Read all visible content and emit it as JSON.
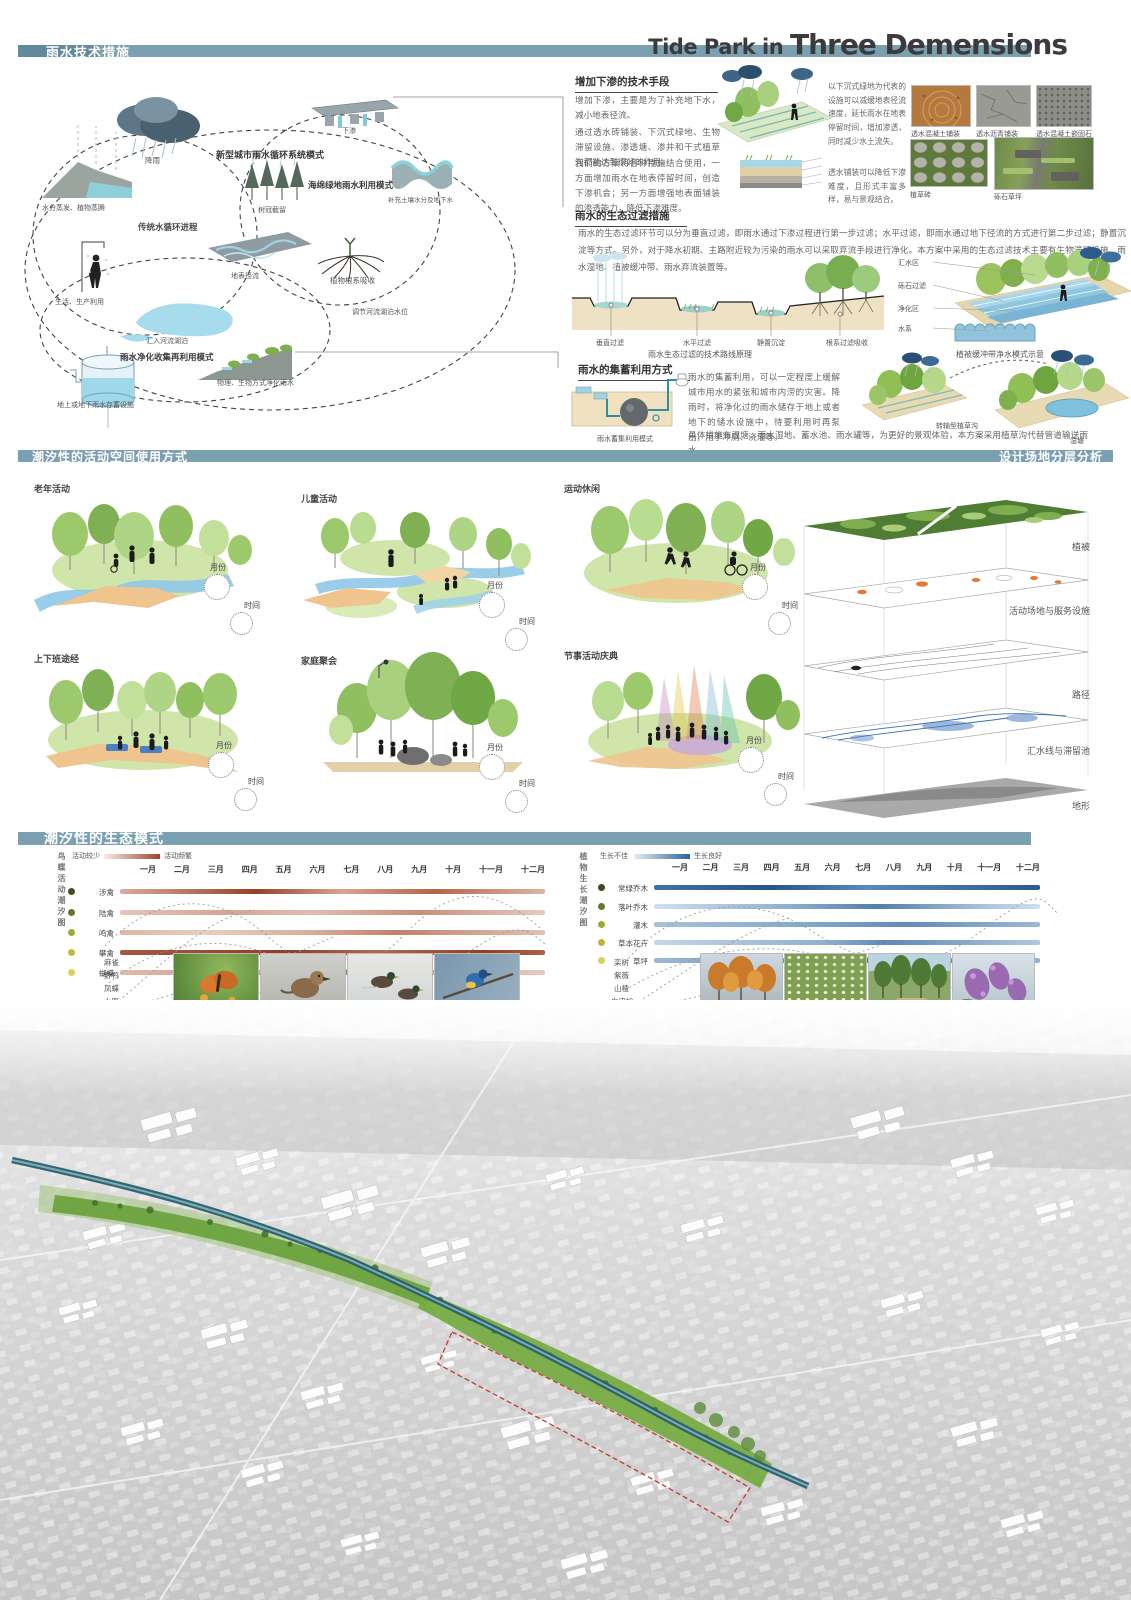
{
  "colors": {
    "bar_teal": "#7aa0b1",
    "bar_teal_dark": "#62899c",
    "orange_band": "#b35b36",
    "blue_band": "#2f6da8",
    "title_ink": "#3b3b3d"
  },
  "header": {
    "section1_title": "雨水技术措施",
    "poster_title_light": "Tide Park in ",
    "poster_title_bold": "Three Demensions",
    "section2_title_left": "潮汐性的活动空间使用方式",
    "section2_title_right": "设计场地分层分析",
    "section3_title": "潮汐性的生态模式"
  },
  "cycle": {
    "rain": "降雨",
    "new_mode": "新型城市雨水循环系统模式",
    "traditional": "传统水循环进程",
    "evaporation": "水分蒸发、植物蒸腾",
    "canopy": "树冠截留",
    "infiltration": "下渗",
    "sponge_mode": "海绵绿地雨水利用模式",
    "soil_water": "补充土壤水分及地下水",
    "roots": "植物根系吸收",
    "runoff": "地表径流",
    "life_use": "生活、生产利用",
    "to_river": "汇入河流湖泊",
    "regulate": "调节河流湖泊水位",
    "purify_mode": "雨水净化收集再利用模式",
    "purify_ways": "物理、生物方式净化雨水",
    "storage": "地上或地下雨水存蓄设施"
  },
  "infil": {
    "heading": "增加下渗的技术手段",
    "p1": "增加下渗，主要是为了补充地下水，减小地表径流。",
    "p2": "通过透水砖铺装、下沉式绿地、生物滞留设施、渗透塘、渗井和干式植草沟都能达到很好的作用。",
    "p3": "我们的方案将各种措施结合使用，一方面增加雨水在地表停留时间，创造下渗机会；另一方面增强地表面铺装的渗透能力，降低下渗难度。",
    "note1": "以下沉式绿地为代表的设施可以减缓地表径流速度，延长雨水在地表停留时间，增加渗透，同时减少水土流失。",
    "note2": "透水铺装可以降低下渗难度，且形式丰富多样，易与景观结合。",
    "photos": [
      "透水混凝土铺装",
      "透水沥青铺装",
      "透水混凝土嵌固石",
      "植草砖",
      "砾石草坪"
    ]
  },
  "filter": {
    "heading": "雨水的生态过滤措施",
    "p1": "雨水的生态过滤环节可以分为垂直过滤，即雨水通过下渗过程进行第一步过滤；水平过滤，即雨水通过地下径流的方式进行第二步过滤；静置沉淀等方式。另外，对于降水初期、主路附近较为污染的雨水可以采取弃流手段进行净化。本方案中采用的生态过滤技术主要有生物滞留设施、雨水湿地、植被缓冲带、雨水弃流装置等。",
    "steps": [
      "垂直过滤",
      "水平过滤",
      "静置沉淀",
      "根系过滤吸收"
    ],
    "caption_left": "雨水生态过滤的技术路线原理",
    "callouts": [
      "汇水区",
      "砾石过滤",
      "净化区",
      "水系"
    ],
    "caption_right": "植被缓冲带净水模式示意"
  },
  "store": {
    "heading": "雨水的集蓄利用方式",
    "caption": "雨水蓄集利用模式",
    "p1": "雨水的集蓄利用，可以一定程度上缓解城市用水的紧张和城市内涝的灾害。降雨时，将净化过的雨水储存于地上或者地下的储水设施中，待要利用时再泵出，用于冲厕、浇灌等。",
    "p2": "具体措施有湿塘、雨水湿地、蓄水池、雨水罐等，为更好的景观体验，本方案采用植草沟代替管道输送雨水。",
    "swale": "转输型植草沟",
    "pond": "湿塘"
  },
  "act": {
    "month": "月份",
    "time": "时间",
    "items": [
      "老年活动",
      "儿童活动",
      "运动休闲",
      "上下班途经",
      "家庭聚会",
      "节事活动庆典"
    ]
  },
  "layers": {
    "items": [
      "植被",
      "活动场地与服务设施",
      "路径",
      "汇水线与滞留池",
      "地形"
    ]
  },
  "eco": {
    "months": [
      "一月",
      "二月",
      "三月",
      "四月",
      "五月",
      "六月",
      "七月",
      "八月",
      "九月",
      "十月",
      "十一月",
      "十二月"
    ],
    "bird": {
      "axis": "鸟蝶活动潮汐图",
      "lo": "活动较少",
      "hi": "活动频繁",
      "rows": [
        "涉禽",
        "陆禽",
        "鸣禽",
        "攀禽",
        "蝴蝶"
      ],
      "species": [
        "麻雀",
        "野鸭",
        "凤蝶",
        "大雁"
      ]
    },
    "plant": {
      "axis": "植物生长潮汐图",
      "lo": "生长不佳",
      "hi": "生长良好",
      "rows": [
        "常绿乔木",
        "落叶乔木",
        "灌木",
        "草本花卉",
        "草坪"
      ],
      "species": [
        "栾树",
        "紫薇",
        "山楂",
        "白皮松"
      ]
    }
  }
}
